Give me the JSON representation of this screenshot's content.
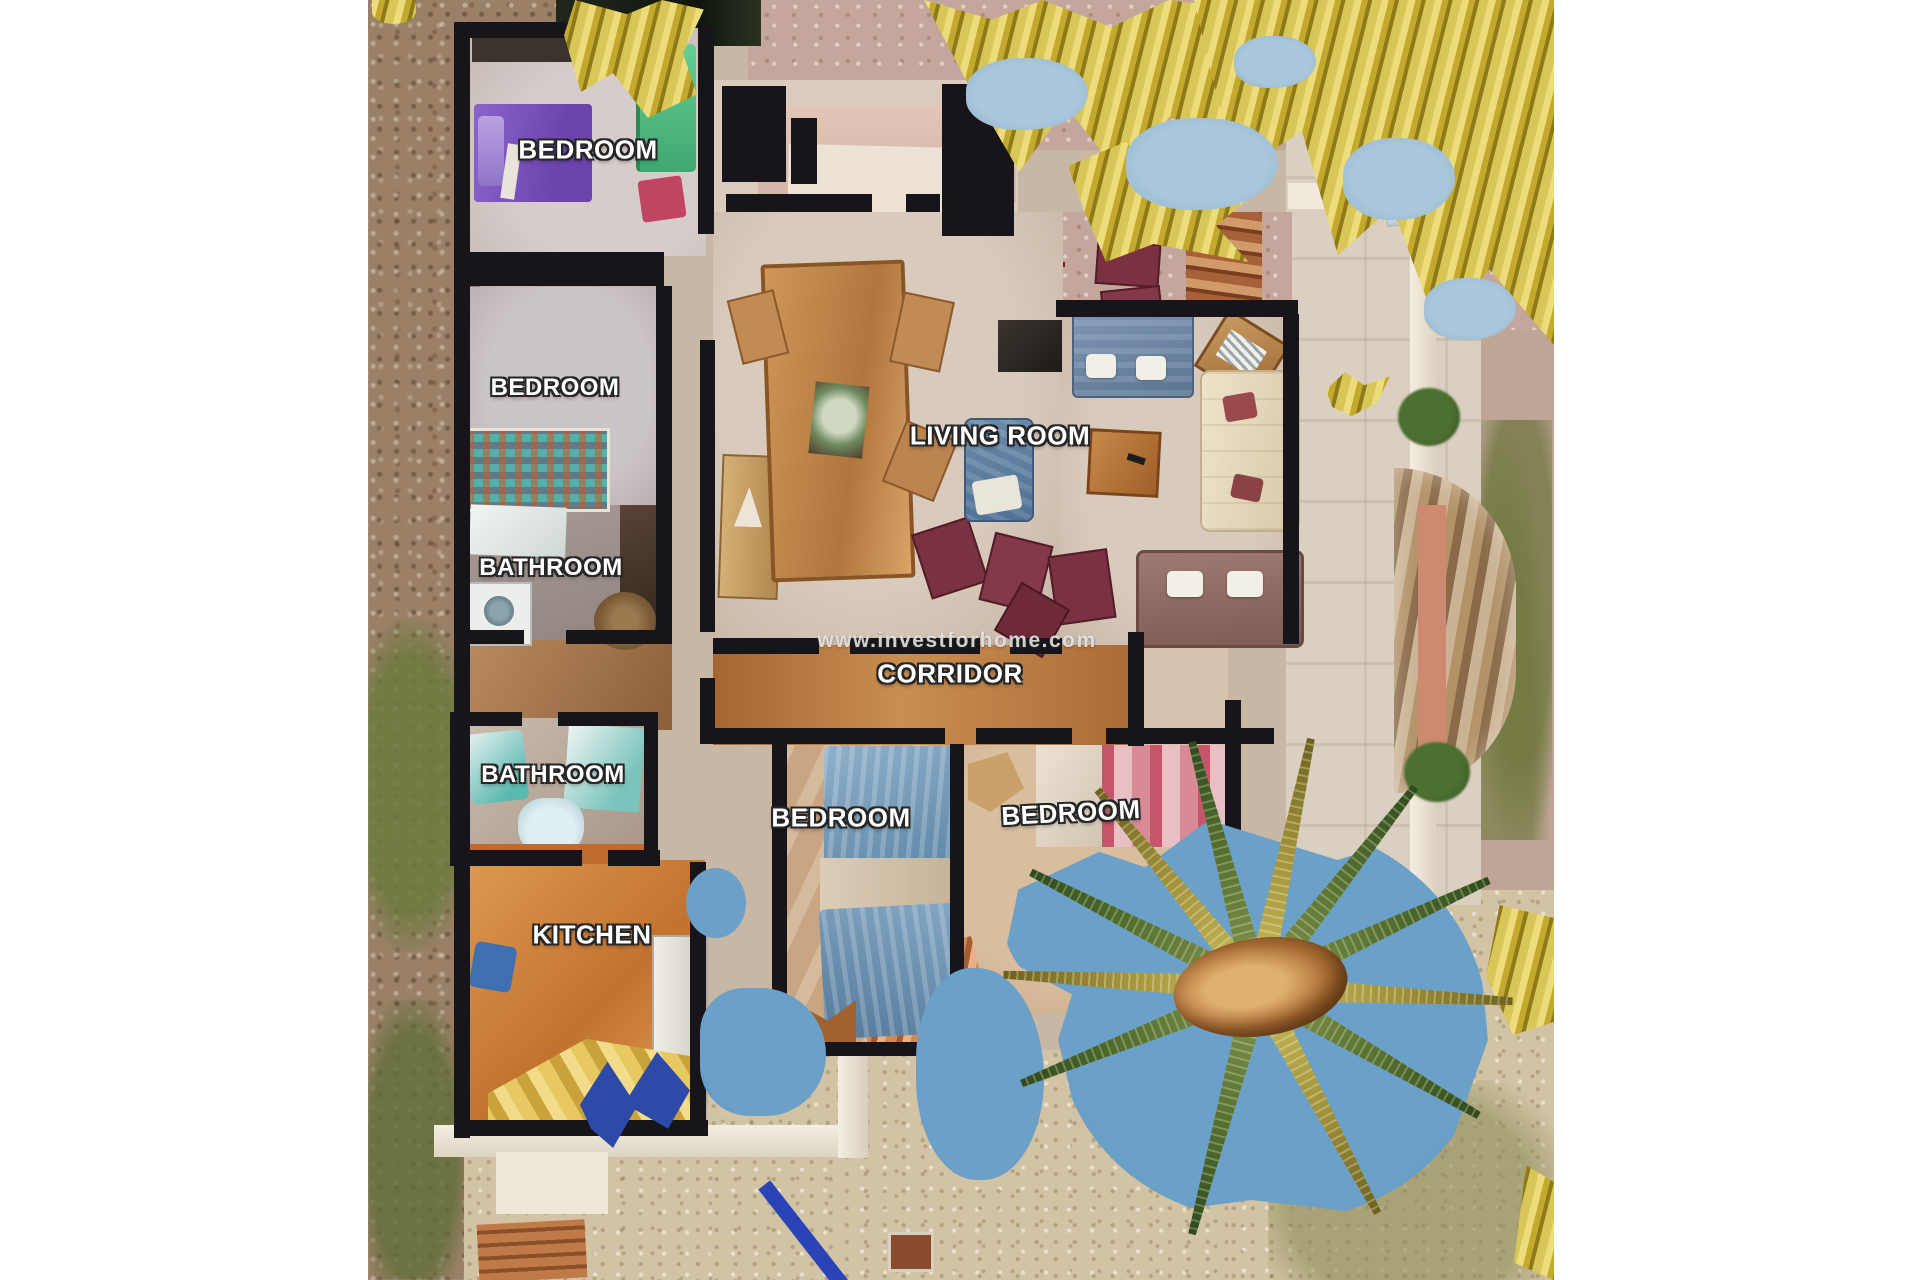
{
  "floorplan": {
    "watermark": "www.investforhome.com",
    "labels": {
      "bedroom1": "BEDROOM",
      "bedroom2": "BEDROOM",
      "bathroom1": "BATHROOM",
      "bathroom2": "BATHROOM",
      "kitchen": "KITCHEN",
      "living_room": "LIVING ROOM",
      "corridor": "CORRIDOR",
      "bedroom3": "BEDROOM",
      "bedroom4": "BEDROOM"
    },
    "colors": {
      "wall": "#17151a",
      "gold_foliage": "#c3a92e",
      "sky_artifact": "#6ba0c8",
      "palm_green": "#55702f",
      "corridor_floor": "#b06f3d",
      "kitchen_floor": "#c87f3e",
      "bed_purple": "#7a52c0",
      "bed_green": "#56c289",
      "bed_blue": "#7fa3c0",
      "bed_pink": "#d08d9a",
      "sofa_blue": "#6d87a6",
      "sofa_cream": "#e8dcc4",
      "chair_maroon": "#7a3240"
    }
  }
}
